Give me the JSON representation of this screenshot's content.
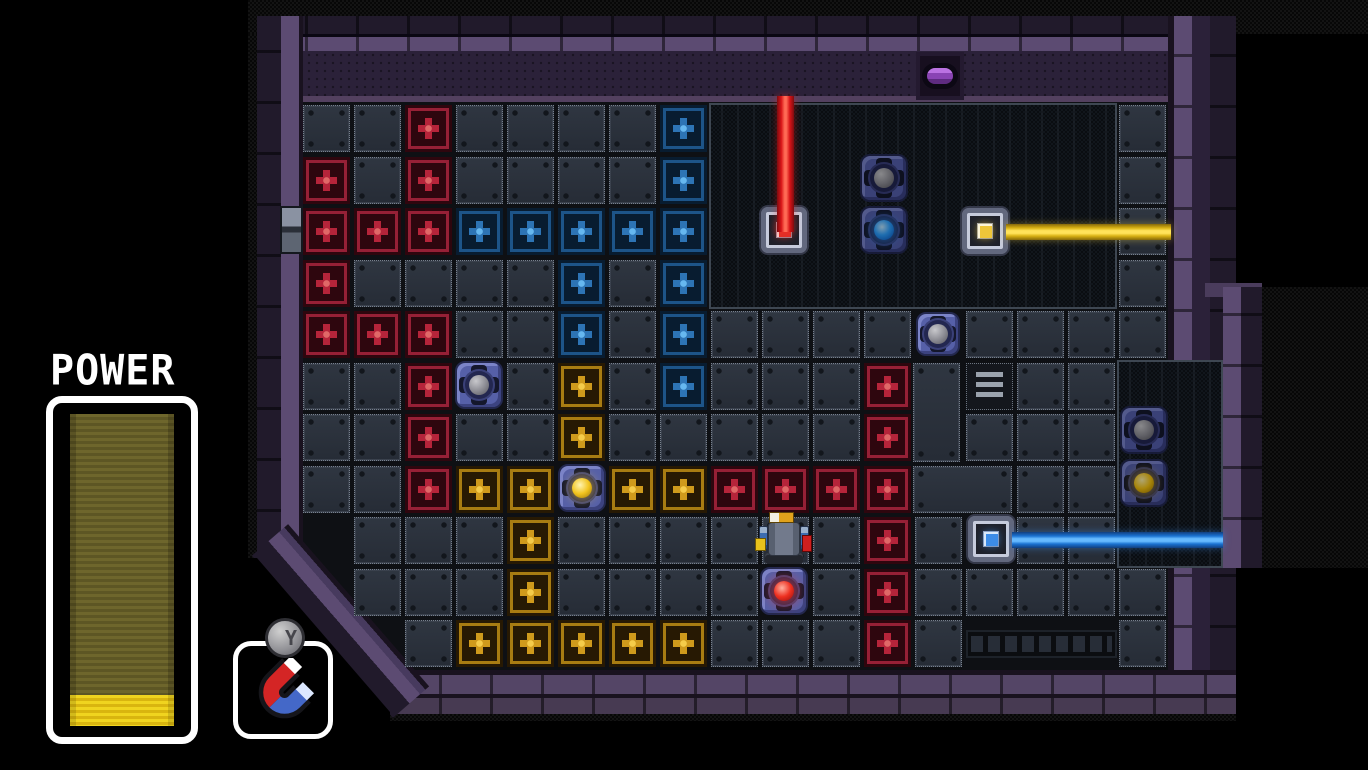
{
  "hud": {
    "power_label": "POWER",
    "power_percent": 10,
    "item_button_label": "Y",
    "item_name": "magnet"
  },
  "board": {
    "grid": {
      "cols": 17,
      "rows": 11,
      "origin_x": 301,
      "origin_y": 103,
      "cell_w": 51,
      "cell_h": 51.5,
      "tile": 47
    },
    "legend": {
      ".": "floor-tile",
      "R": "red-cross-tile",
      "B": "blue-cross-tile",
      "Y": "gold-cross-tile",
      "#": "pit",
      "_": "empty"
    },
    "tile_map": [
      "..R....B########.",
      "R.R....B########.",
      "RRRBBBBB########.",
      "R....B.B########.",
      "RRR..B.B...._....",
      "..R_.Y.B...R__..#",
      "..R..Y.....R_...#",
      "..RYY_YYRRRR__..#",
      "_...Y......R._..#",
      "_...Y...._.R.....",
      "__.YYYYY...R.___."
    ],
    "pits": [
      {
        "name": "upper-right-pit",
        "x": 709,
        "y": 103,
        "w": 408,
        "h": 206
      },
      {
        "name": "right-side-pit",
        "x": 1117,
        "y": 360,
        "w": 106,
        "h": 208
      }
    ],
    "panels": [
      {
        "x": 913,
        "y": 363,
        "w": 47,
        "h": 99
      },
      {
        "x": 913,
        "y": 466,
        "w": 99,
        "h": 47
      }
    ],
    "grates": [
      {
        "kind": "vent",
        "x": 966,
        "y": 363,
        "w": 47,
        "h": 47
      },
      {
        "kind": "channel",
        "x": 966,
        "y": 630,
        "w": 151,
        "h": 28
      }
    ],
    "doors": [
      {
        "side": "top",
        "x": 916,
        "y": 52,
        "w": 48,
        "h": 48
      },
      {
        "side": "left",
        "x": 280,
        "y": 206,
        "w": 23,
        "h": 48
      }
    ],
    "beams": [
      {
        "color": "red",
        "dir": "v",
        "x": 777,
        "y": 96,
        "len": 136,
        "w": 17
      },
      {
        "color": "yellow",
        "dir": "h",
        "x": 1006,
        "y": 224,
        "len": 165,
        "w": 16
      },
      {
        "color": "blue",
        "dir": "h",
        "x": 1012,
        "y": 532,
        "len": 211,
        "w": 16
      }
    ],
    "devices": [
      {
        "id": "laser-receiver-red",
        "kind": "socket",
        "color": "red",
        "x": 759,
        "y": 205,
        "s": 50,
        "dim": false
      },
      {
        "id": "laser-emitter-yellow",
        "kind": "socket",
        "color": "yellow",
        "x": 960,
        "y": 206,
        "s": 50,
        "dim": false
      },
      {
        "id": "laser-emitter-blue",
        "kind": "socket",
        "color": "blue",
        "x": 966,
        "y": 514,
        "s": 50,
        "dim": false
      },
      {
        "id": "orb-socket-gray-pit",
        "kind": "orb",
        "color": "gray",
        "x": 860,
        "y": 154,
        "s": 48,
        "dim": true
      },
      {
        "id": "orb-socket-blue-pit",
        "kind": "orb",
        "color": "blue",
        "x": 860,
        "y": 206,
        "s": 48,
        "dim": true
      },
      {
        "id": "orb-socket-gray-mid",
        "kind": "orb",
        "color": "gray",
        "x": 916,
        "y": 312,
        "s": 44,
        "dim": false
      },
      {
        "id": "orb-socket-gray-left",
        "kind": "orb",
        "color": "gray",
        "x": 455,
        "y": 361,
        "s": 48,
        "dim": false
      },
      {
        "id": "orb-socket-yellow-left",
        "kind": "orb",
        "color": "yellow",
        "x": 558,
        "y": 464,
        "s": 48,
        "dim": false
      },
      {
        "id": "orb-socket-red",
        "kind": "orb",
        "color": "red",
        "x": 760,
        "y": 567,
        "s": 48,
        "dim": false
      },
      {
        "id": "orb-socket-gray-right",
        "kind": "orb",
        "color": "gray",
        "x": 1120,
        "y": 406,
        "s": 48,
        "dim": true
      },
      {
        "id": "orb-socket-yellow-right",
        "kind": "orb",
        "color": "yellow",
        "x": 1120,
        "y": 459,
        "s": 48,
        "dim": true
      }
    ],
    "player": {
      "x": 755,
      "y": 508
    }
  },
  "palette": {
    "laser_red": "#d81418",
    "laser_yellow": "#d9b214",
    "laser_blue": "#1a72d2",
    "wall_purple": "#5c4b72",
    "wall_dark": "#211a2b",
    "floor_tile": "#2a303b",
    "power_fill": "#f0d41f",
    "magnet_red": "#d42525",
    "magnet_blue": "#4468c8"
  }
}
